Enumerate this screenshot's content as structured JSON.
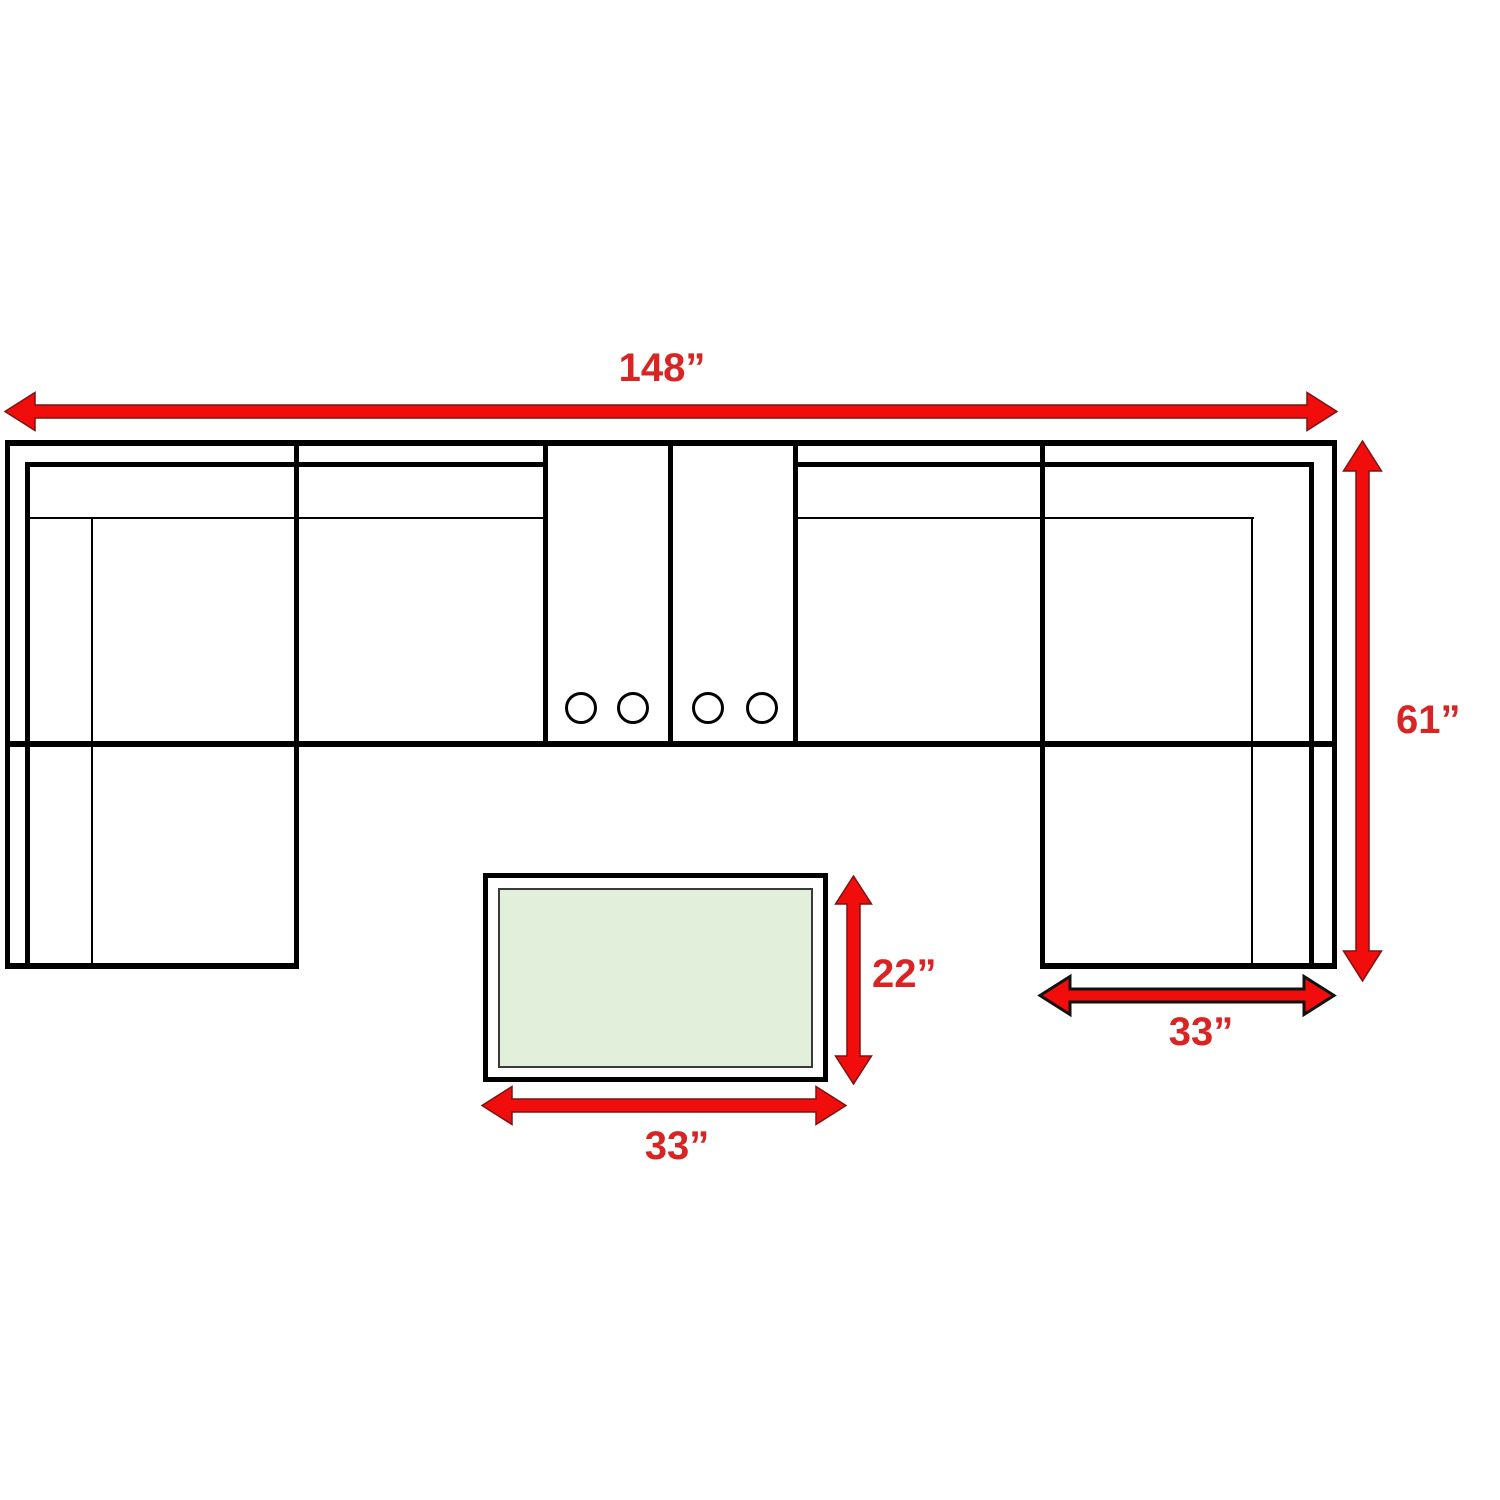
{
  "diagram": {
    "sectional": {
      "width": "148”",
      "depth": "61”",
      "corner_section_width": "33”"
    },
    "coffee_table": {
      "width": "33”",
      "depth": "22”"
    },
    "colors": {
      "arrow": "#f20d0d",
      "label": "#da2423",
      "line": "#000000",
      "table_fill": "#e2efda"
    }
  }
}
